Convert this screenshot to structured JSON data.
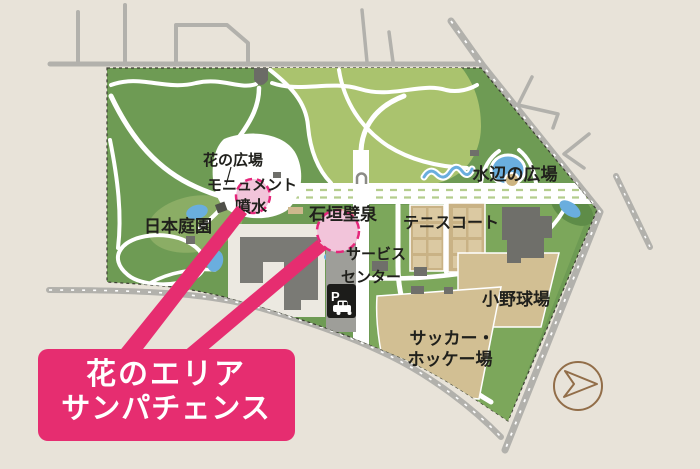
{
  "map": {
    "area_labels": {
      "flower_plaza": "花の広場",
      "monument_fountain_line1": "モニュメント",
      "monument_fountain_line2": "噴水",
      "japanese_garden": "日本庭園",
      "ishigaki_wall_fountain": "石垣壁泉",
      "service_center_line1": "サービス",
      "service_center_line2": "センター",
      "waterside_plaza": "水辺の広場",
      "tennis_court": "テニスコート",
      "ono_baseball_field": "小野球場",
      "soccer_hockey_line1": "サッカー・",
      "soccer_hockey_line2": "ホッケー場"
    },
    "callout": {
      "line1": "花のエリア",
      "line2": "サンパチェンス"
    },
    "parking_sign": "P",
    "colors": {
      "accent_pink": "#e62d70",
      "highlight_circle_fill": "#f2c4da",
      "park_green_dark": "#6e9b54",
      "park_green_light": "#aac36e",
      "sports_green": "#7ca75b",
      "field_tan": "#d2bf93",
      "water_blue": "#6aaede",
      "road_gray": "#b2b1ac",
      "building_gray": "#757570",
      "background_beige": "#e8e3d9",
      "compass_brown": "#926e49"
    }
  }
}
